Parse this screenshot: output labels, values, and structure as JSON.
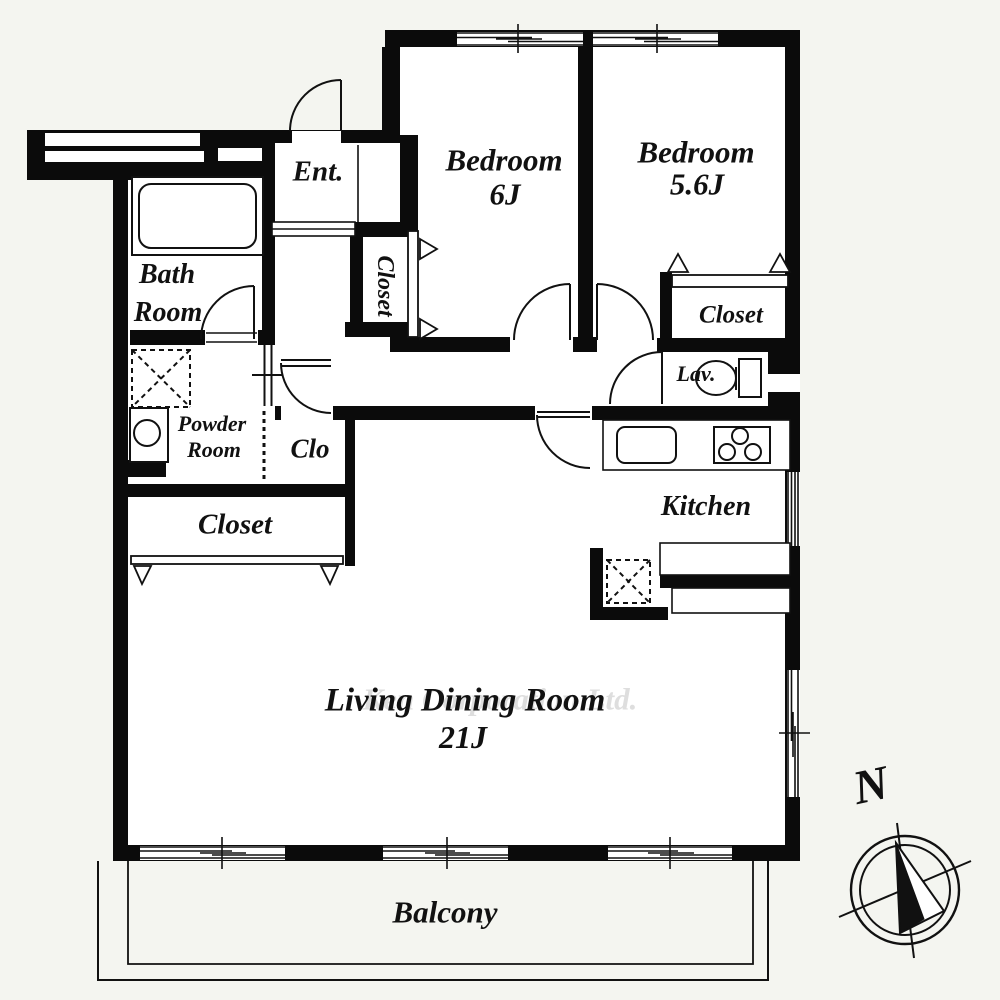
{
  "plan_title": "2LDK apartment floor plan",
  "rooms": {
    "bedroom_6j": {
      "name": "Bedroom",
      "size": "6J"
    },
    "bedroom_56j": {
      "name": "Bedroom",
      "size": "5.6J"
    },
    "closet_bedroom": {
      "label": "Closet"
    },
    "closet_entrance": {
      "label": "Closet"
    },
    "closet_hallway": {
      "label": "Closet"
    },
    "closet_small": {
      "label": "Clo"
    },
    "entrance": {
      "label": "Ent."
    },
    "bathroom": {
      "label_line1": "Bath",
      "label_line2": "Room"
    },
    "powder_room": {
      "label_line1": "Powder",
      "label_line2": "Room"
    },
    "lavatory": {
      "label": "Lav."
    },
    "kitchen": {
      "label": "Kitchen"
    },
    "living_dining": {
      "name": "Living Dining Room",
      "size": "21J"
    },
    "balcony": {
      "label": "Balcony"
    }
  },
  "compass": {
    "north_label": "N"
  },
  "watermark": {
    "text": "Ken Corporation Ltd."
  },
  "colors": {
    "wall": "#0b0b0b",
    "floor": "#ffffff",
    "background": "#f4f5f0",
    "watermark": "#dedede",
    "line": "#111111"
  }
}
